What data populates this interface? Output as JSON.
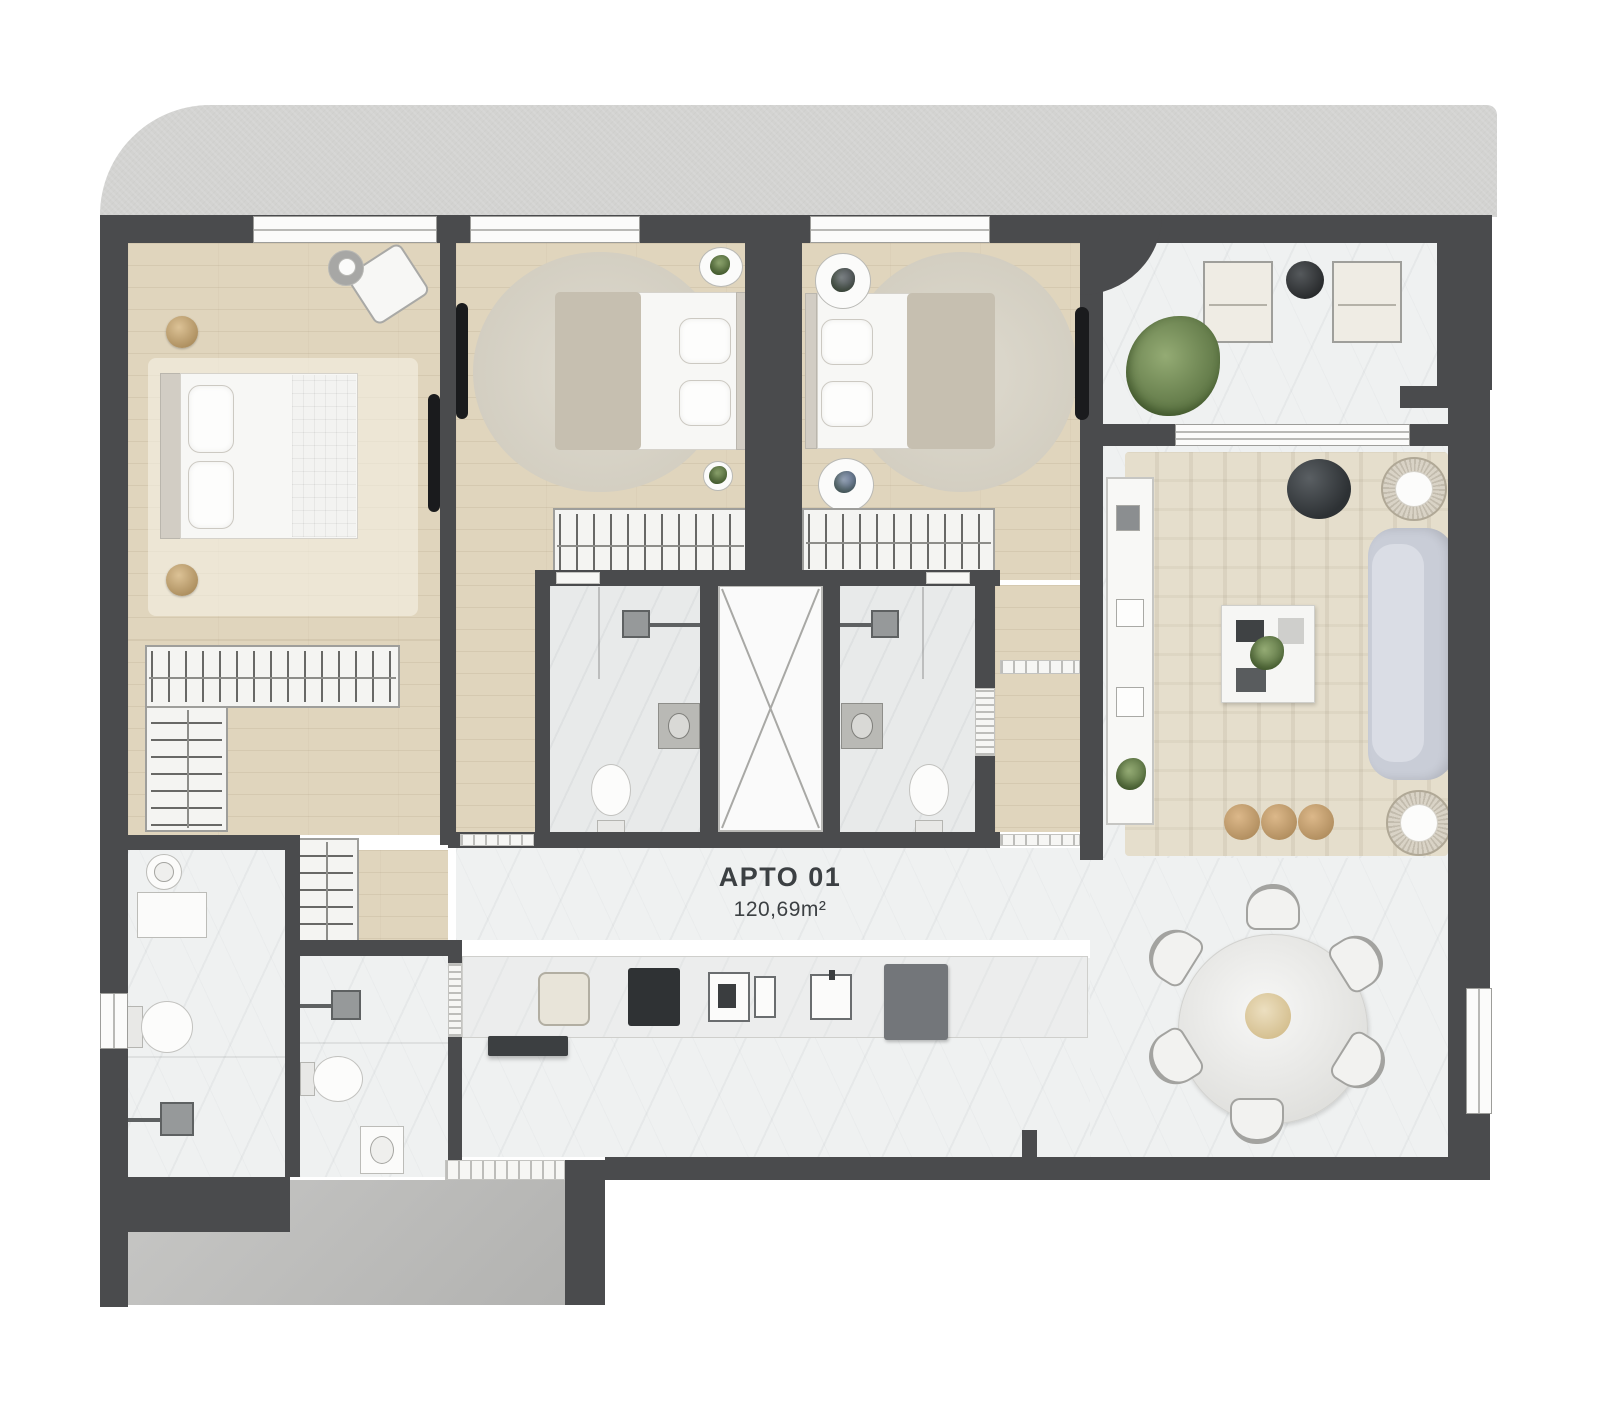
{
  "plan": {
    "title": "APTO 01",
    "area": "120,69m²"
  },
  "colors": {
    "background": "#ffffff",
    "slab": "#d3d3d1",
    "wall": "#4a4b4d",
    "wood_floor": "#e0d5bd",
    "marble_floor": "#eff1f1",
    "service_floor": "#bcbcba",
    "living_rug": "#e5decc",
    "bedroom_rug": "#d7d2c4",
    "sofa": "#c9cdd7",
    "dark_accent": "#33373a",
    "plant": "#6f8a52",
    "tan_accent": "#c9a87c",
    "label_text": "#3c4043"
  }
}
